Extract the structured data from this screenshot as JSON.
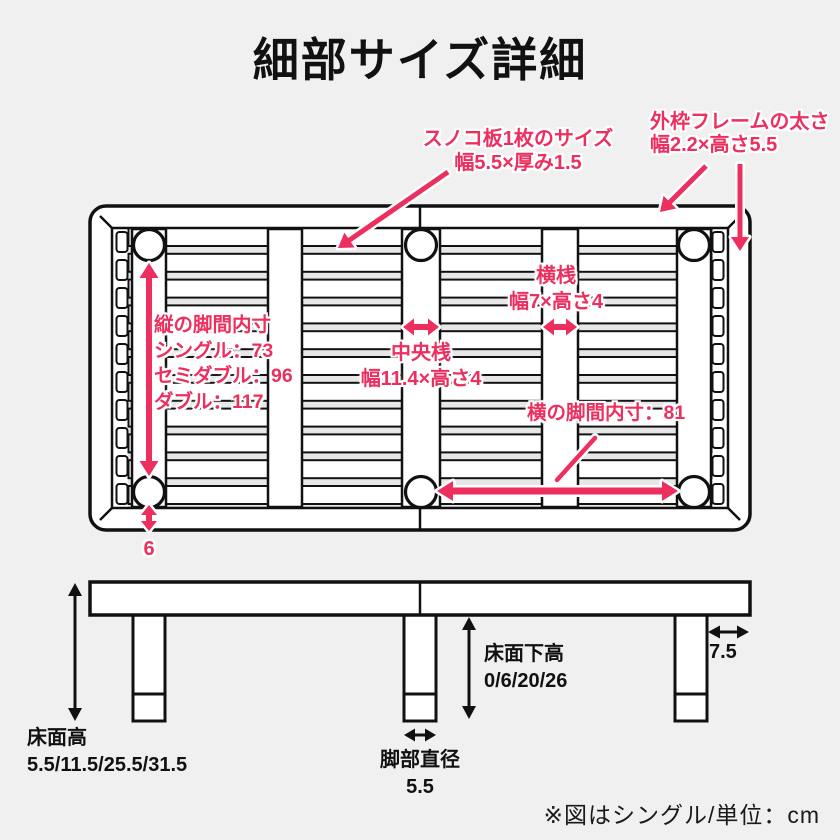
{
  "title": "細部サイズ詳細",
  "unit_note": "※図はシングル/単位：cm",
  "colors": {
    "accent": "#ED2F5F",
    "ink": "#111111",
    "background": "#F0F0F0"
  },
  "top_view": {
    "slat_label": {
      "line1": "スノコ板1枚のサイズ",
      "line2": "幅5.5×厚み1.5"
    },
    "outer_frame_label": {
      "line1": "外枠フレームの太さ",
      "line2": "幅2.2×高さ5.5"
    },
    "leg_span_vertical": {
      "line1": "縦の脚間内寸",
      "line2": "シングル：73",
      "line3": "セミダブル：96",
      "line4": "ダブル：117"
    },
    "center_rail_label": {
      "line1": "中央桟",
      "line2": "幅11.4×高さ4"
    },
    "cross_rail_label": {
      "line1": "横桟",
      "line2": "幅7×高さ4"
    },
    "leg_span_horizontal": "横の脚間内寸：81",
    "leg_edge_offset": "6"
  },
  "side_view": {
    "floor_height": {
      "line1": "床面高",
      "line2": "5.5/11.5/25.5/31.5"
    },
    "under_floor_height": {
      "line1": "床面下高",
      "line2": "0/6/20/26"
    },
    "side_offset": "7.5",
    "leg_diameter": {
      "line1": "脚部直径",
      "line2": "5.5"
    }
  }
}
